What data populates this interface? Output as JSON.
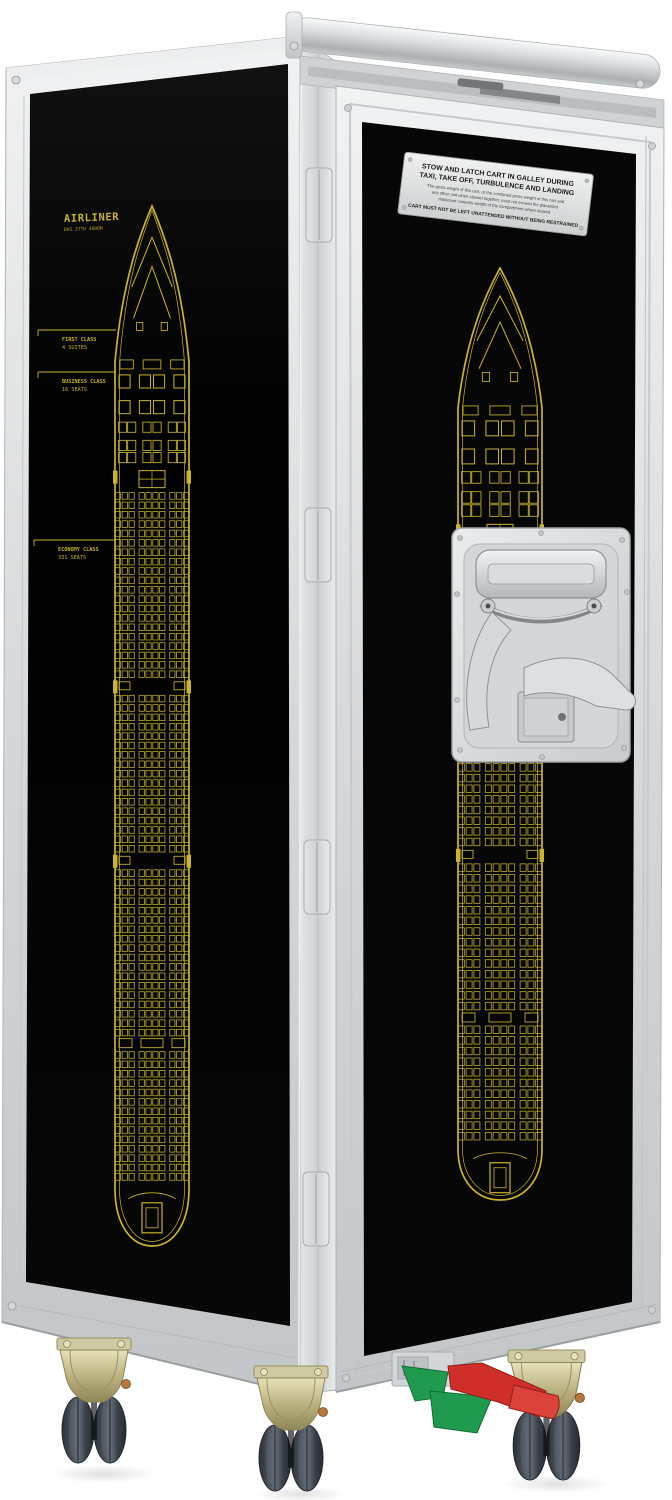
{
  "side_panel": {
    "title": "AIRLINER",
    "subtitle": "DHS 37TH 4000M",
    "sections": [
      {
        "name": "FIRST CLASS",
        "detail": "4 SUITES"
      },
      {
        "name": "BUSINESS CLASS",
        "detail": "16 SEATS"
      },
      {
        "name": "ECONOMY CLASS",
        "detail": "331 SEATS"
      }
    ]
  },
  "placard": {
    "heading_line1": "STOW AND LATCH CART IN GALLEY DURING",
    "heading_line2": "TAXI, TAKE OFF, TURBULENCE AND LANDING",
    "body_line1": "The gross weight of this cart, or the combined gross weight of this cart and",
    "body_line2": "any other cart when stowed together, must not exceed the placarded",
    "body_line3": "maximum contents weight of the compartment where stowed",
    "footer": "CART MUST NOT BE LEFT UNATTENDED WITHOUT BEING RESTRAINED"
  },
  "colors": {
    "frame_silver": "#d6d9db",
    "panel_black": "#050505",
    "blueprint_yellow": "#c9b42c",
    "placard_gray": "#e3e4e5",
    "pedal_red": "#cf2f28",
    "pedal_green": "#1f9a4e",
    "tire_gray": "#454c55",
    "caster_brass": "#b9b07c"
  }
}
